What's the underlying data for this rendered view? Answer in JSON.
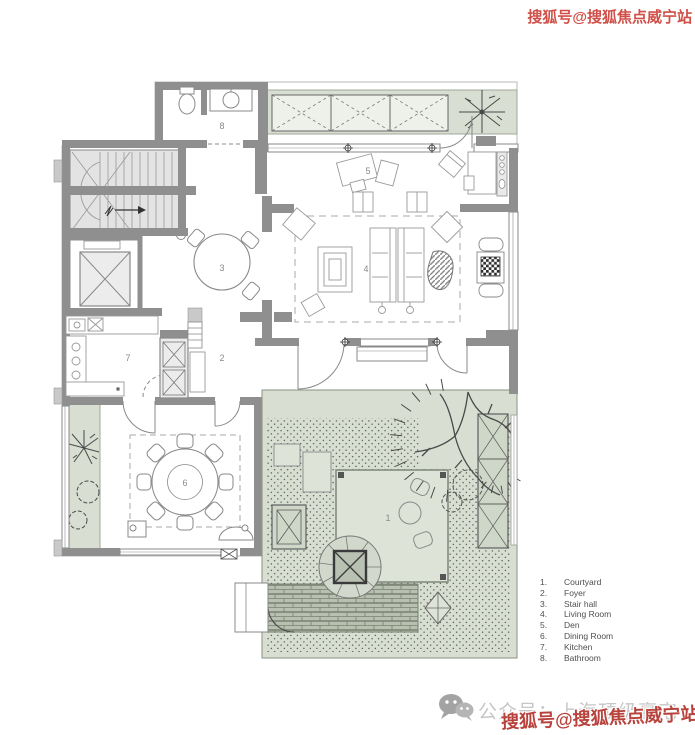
{
  "watermarks": {
    "top_right": "搜狐号@搜狐焦点威宁站",
    "bottom_right": "搜狐号@搜狐焦点威宁站",
    "bottom_center": "公众号：上海顶级豪宅",
    "red_color": "#c0453f",
    "gray_color": "#c6c6c6"
  },
  "icons": {
    "bottom_logo": "wechat-icon"
  },
  "legend": {
    "items": [
      {
        "num": "1.",
        "label": "Courtyard"
      },
      {
        "num": "2.",
        "label": "Foyer"
      },
      {
        "num": "3.",
        "label": "Stair hall"
      },
      {
        "num": "4.",
        "label": "Living Room"
      },
      {
        "num": "5.",
        "label": "Den"
      },
      {
        "num": "6.",
        "label": "Dining Room"
      },
      {
        "num": "7.",
        "label": "Kitchen"
      },
      {
        "num": "8.",
        "label": "Bathroom"
      }
    ]
  },
  "plan": {
    "room_labels": {
      "courtyard": "1",
      "foyer": "2",
      "stair_hall": "3",
      "living_room": "4",
      "den": "5",
      "dining_room": "6",
      "kitchen": "7",
      "bathroom": "8"
    },
    "colors": {
      "wall": "#8f8f8f",
      "green": "#d8dfd2",
      "platform": "#dde3d7",
      "stair_fill": "#e3e3e3"
    }
  }
}
